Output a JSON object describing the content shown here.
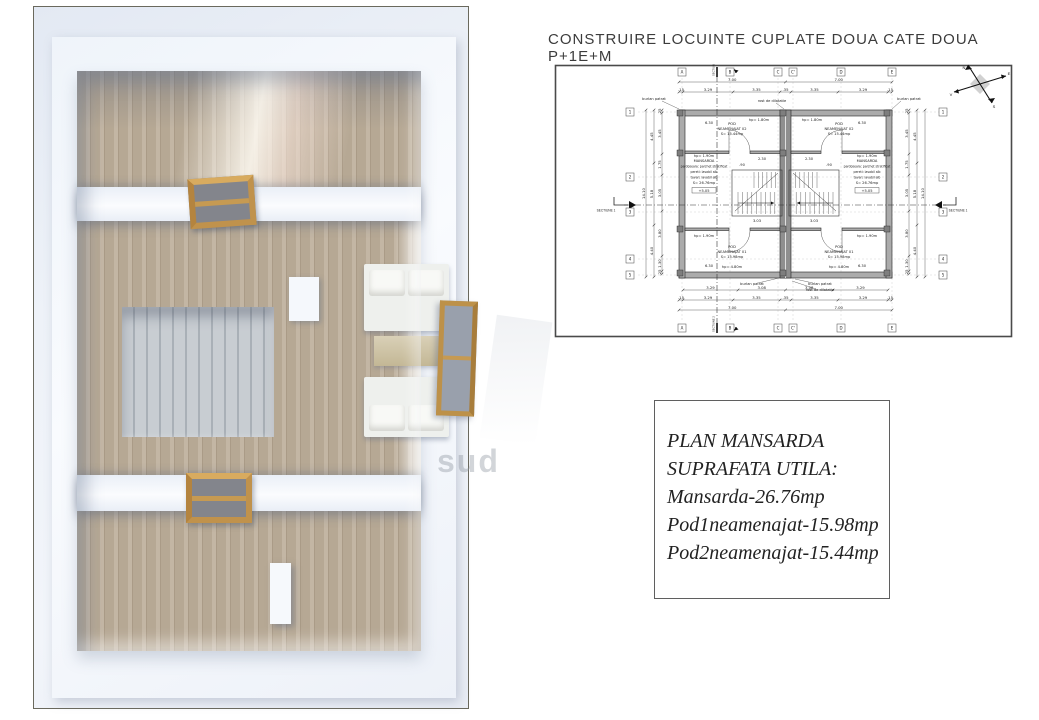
{
  "title": "CONSTRUIRE LOCUINTE CUPLATE DOUA CATE DOUA P+1E+M",
  "watermark": "sud",
  "summary_box": {
    "lines": [
      "PLAN MANSARDA",
      "SUPRAFATA UTILA:",
      "Mansarda-26.76mp",
      "Pod1neamenajat-15.98mp",
      "Pod2neamenajat-15.44mp"
    ]
  },
  "plan": {
    "grid_cols": [
      "A",
      "B",
      "C",
      "C'",
      "D",
      "E"
    ],
    "grid_rows": [
      "1",
      "2",
      "3",
      "4",
      "5"
    ],
    "rooms": {
      "pod02": [
        "POD",
        "NEAMENAJAT 02",
        "S= 15.44mp"
      ],
      "pod01": [
        "POD",
        "NEAMENAJAT 01",
        "S= 15.98mp"
      ],
      "mansarda": [
        "MANSARDA",
        "pardoseala: parchet stratificat",
        "pereti: lavabil alb",
        "tavan: lavabil alb",
        "S= 26.76mp"
      ],
      "elevation": "+5.05"
    },
    "knee_labels": {
      "top": "hp= 1.80m",
      "mid": "hp= 1.90m",
      "bottom": "hp= 4.80m"
    },
    "leaders": {
      "burlan": "burlan patrat",
      "rost": "rost de dilatatie"
    },
    "sections": {
      "s1": "SECTIUNE 1",
      "s2": "SECTIUNE 2"
    },
    "compass": {
      "n": "N",
      "e": "E",
      "s": "S",
      "v": "V"
    },
    "dims": {
      "top_totals": [
        "7.00",
        "7.00"
      ],
      "top_detail": [
        ".15",
        "3.29",
        "3.35",
        ".35",
        "3.35",
        "3.29",
        ".15"
      ],
      "bottom_row1": [
        "3.29",
        "3.08",
        "3.08",
        "3.29"
      ],
      "bottom_detail": [
        ".15",
        "3.29",
        "3.35",
        ".35",
        "3.35",
        "3.29",
        ".15"
      ],
      "bottom_totals": [
        "7.00",
        "7.00"
      ],
      "side_detail": [
        ".25",
        "3.45",
        "1.75",
        "3.05",
        "3.80",
        "1.30",
        ".25"
      ],
      "side_mid": [
        "4.45",
        "5.18",
        "4.40"
      ],
      "side_total": [
        "14.10"
      ],
      "inner": [
        "6.30",
        "2.30",
        ".90",
        "3.03",
        "6.30"
      ]
    }
  },
  "colors": {
    "wood": "#bcae9c",
    "wood_frame": "#c0924c",
    "plan_wall": "#ababab",
    "accent_line": "#444444",
    "render_bg": "#e9eef6"
  }
}
